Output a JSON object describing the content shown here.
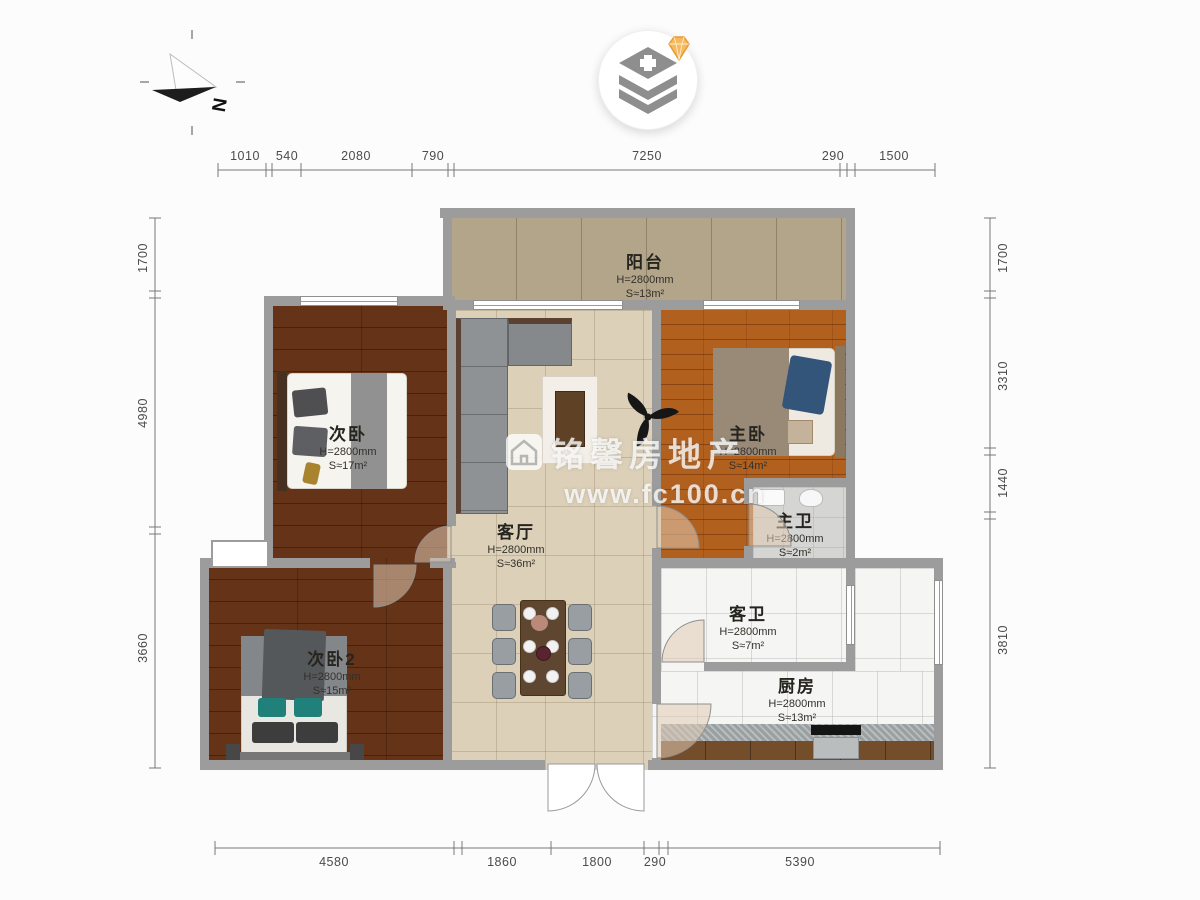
{
  "compass": {
    "label": "N"
  },
  "watermark": {
    "brand": "铭馨房地产",
    "url": "www.fc100.cn"
  },
  "rooms": [
    {
      "id": "balcony",
      "name": "阳台",
      "height": "H=2800mm",
      "area": "S≈13m²"
    },
    {
      "id": "bedroom2",
      "name": "次卧",
      "height": "H=2800mm",
      "area": "S≈17m²"
    },
    {
      "id": "master",
      "name": "主卧",
      "height": "H=2800mm",
      "area": "S≈14m²"
    },
    {
      "id": "living",
      "name": "客厅",
      "height": "H=2800mm",
      "area": "S≈36m²"
    },
    {
      "id": "masterbath",
      "name": "主卫",
      "height": "H=2800mm",
      "area": "S≈2m²"
    },
    {
      "id": "guestbath",
      "name": "客卫",
      "height": "H=2800mm",
      "area": "S≈7m²"
    },
    {
      "id": "kitchen",
      "name": "厨房",
      "height": "H=2800mm",
      "area": "S≈13m²"
    },
    {
      "id": "bedroom3",
      "name": "次卧2",
      "height": "H=2800mm",
      "area": "S≈15m²"
    }
  ],
  "dimensions": {
    "top": [
      "1010",
      "540",
      "2080",
      "790",
      "7250",
      "290",
      "1500"
    ],
    "bottom": [
      "4580",
      "1860",
      "1800",
      "290",
      "5390"
    ],
    "left": [
      "1700",
      "4980",
      "3660"
    ],
    "right": [
      "1700",
      "3310",
      "1440",
      "3810"
    ]
  },
  "colors": {
    "wall": "#9c9c9c",
    "wood_dark": "#653317",
    "wood_orange": "#b2601e",
    "tile_beige": "#dcd0b8",
    "marble": "#f5f5f3",
    "balcony_tan": "#b2a58a",
    "bath_gray": "#d5d5d3",
    "gem_orange": "#f6b95c"
  }
}
